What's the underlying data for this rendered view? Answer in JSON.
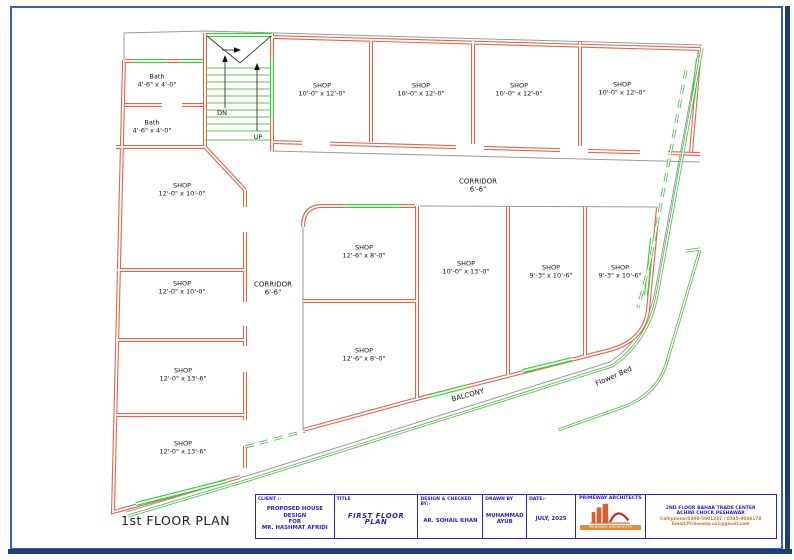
{
  "plan": {
    "label": "1st FLOOR PLAN",
    "stairs": {
      "down_label": "DN",
      "up_label": "UP"
    },
    "rooms": [
      {
        "id": "bath-1",
        "name": "Bath",
        "dims": "4'-6\" x 4'-0\"",
        "x": 157,
        "y": 81
      },
      {
        "id": "bath-2",
        "name": "Bath",
        "dims": "4'-6\" x 4'-0\"",
        "x": 152,
        "y": 127
      },
      {
        "id": "shop-top-1",
        "name": "SHOP",
        "dims": "10'-0\" x 12'-0\"",
        "x": 322,
        "y": 90
      },
      {
        "id": "shop-top-2",
        "name": "SHOP",
        "dims": "10'-0\" x 12'-0\"",
        "x": 421,
        "y": 90
      },
      {
        "id": "shop-top-3",
        "name": "SHOP",
        "dims": "10'-0\" x 12'-0\"",
        "x": 519,
        "y": 90
      },
      {
        "id": "shop-top-4",
        "name": "SHOP",
        "dims": "10'-0\" x 12'-0\"",
        "x": 622,
        "y": 89
      },
      {
        "id": "shop-left-1",
        "name": "SHOP",
        "dims": "12'-0\" x 10'-0\"",
        "x": 182,
        "y": 190
      },
      {
        "id": "shop-left-2",
        "name": "SHOP",
        "dims": "12'-0\" x 10'-0\"",
        "x": 182,
        "y": 288
      },
      {
        "id": "shop-left-3",
        "name": "SHOP",
        "dims": "12'-0\" x 13'-6\"",
        "x": 183,
        "y": 375
      },
      {
        "id": "shop-left-4",
        "name": "SHOP",
        "dims": "12'-0\" x 13'-6\"",
        "x": 183,
        "y": 448
      },
      {
        "id": "shop-mid-1",
        "name": "SHOP",
        "dims": "12'-6\" x 8'-0\"",
        "x": 364,
        "y": 252
      },
      {
        "id": "shop-mid-2",
        "name": "SHOP",
        "dims": "12'-6\" x 8'-0\"",
        "x": 364,
        "y": 355
      },
      {
        "id": "shop-right-1",
        "name": "SHOP",
        "dims": "10'-0\" x 13'-0\"",
        "x": 466,
        "y": 268
      },
      {
        "id": "shop-right-2",
        "name": "SHOP",
        "dims": "9'-3\" x 10'-6\"",
        "x": 551,
        "y": 272
      },
      {
        "id": "shop-right-3",
        "name": "SHOP",
        "dims": "9'-3\" x 10'-6\"",
        "x": 620,
        "y": 272
      }
    ],
    "areas": [
      {
        "id": "corridor-main",
        "name": "CORRIDOR",
        "dims": "6'-6\"",
        "x": 478,
        "y": 186,
        "rot": 0
      },
      {
        "id": "corridor-side",
        "name": "CORRIDOR",
        "dims": "6'-6\"",
        "x": 273,
        "y": 289,
        "rot": 0
      },
      {
        "id": "balcony",
        "name": "BALCONY",
        "dims": "",
        "x": 468,
        "y": 396,
        "rot": -15
      },
      {
        "id": "flower-bed",
        "name": "Flower Bed",
        "dims": "",
        "x": 614,
        "y": 377,
        "rot": -24
      }
    ]
  },
  "title_block": {
    "client_label": "CLIENT :-",
    "client_line1": "PROPOSED HOUSE DESIGN",
    "client_line2": "FOR",
    "client_line3": "MR. HASHMAT AFRIDI",
    "title_label": "TITLE",
    "title_value": "FIRST FLOOR PLAN",
    "designed_label": "DESIGN & CHECKED BY:-",
    "designed_value": "AR. SOHAIL KHAN",
    "drawn_label": "DRAWN BY",
    "drawn_value_line1": "MUHAMMAD",
    "drawn_value_line2": "AYUB",
    "date_label": "DATE:-",
    "date_value": "JULY, 2025",
    "firm_name": "PRIMEWAY ARCHITECTS",
    "firm_banner": "PRIMEWAY ARCHITECTS",
    "address_line1": "2ND FLOOR BAHAR TRADE CENTER",
    "address_line2": "ACHINI CHOCK PESHAWAR",
    "phone_line": "Cell/phone:0300-5901237 / 0345-9046178",
    "email_line": "Email:Primeway.co1@gmail.com"
  },
  "colors": {
    "wall": "#e0664a",
    "window_green": "#2ed32e",
    "boundary_green": "#4db847",
    "plot_gray": "#9a9a9a",
    "frame_blue": "#3a5fae",
    "frame_dark": "#1e3d7b",
    "title_blue": "#2323c8",
    "accent_orange": "#c8742e",
    "logo_orange": "#e8893a"
  }
}
